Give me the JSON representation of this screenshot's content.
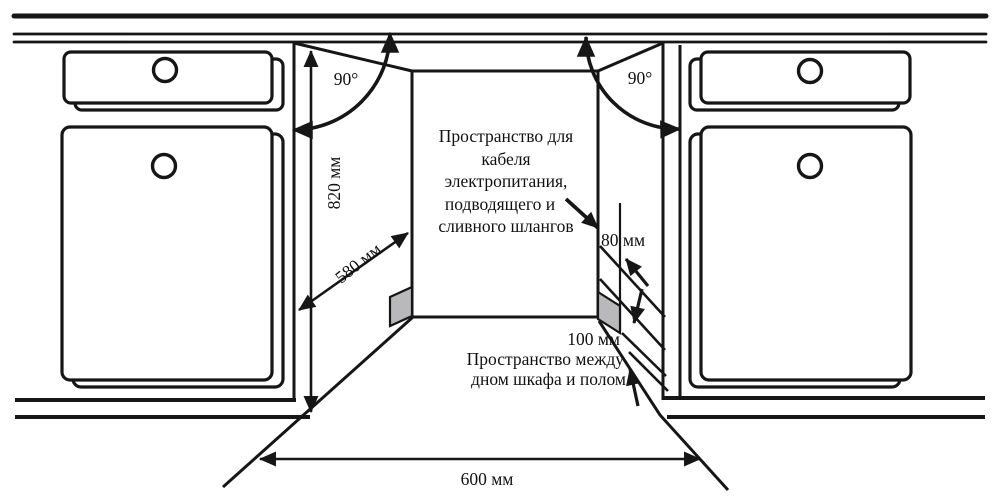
{
  "diagram": {
    "type": "built-in appliance installation clearance diagram",
    "dimensions": {
      "door_angle_left": "90°",
      "door_angle_right": "90°",
      "niche_height": "820 мм",
      "niche_depth": "580 мм",
      "niche_width": "600 мм",
      "cable_space_width": "80 мм",
      "floor_gap": "100 мм"
    },
    "annotations": {
      "cable_space": {
        "line1": "Пространство для",
        "line2": "кабеля",
        "line3": "электропитания,",
        "line4": "подводящего и",
        "line5": "сливного шлангов"
      },
      "floor_space": {
        "line1": "Пространство между",
        "line2": "дном шкафа и полом"
      }
    },
    "colors": {
      "line": "#161616",
      "side_panel_fill": "#b9b9bc",
      "background": "#ffffff"
    }
  }
}
